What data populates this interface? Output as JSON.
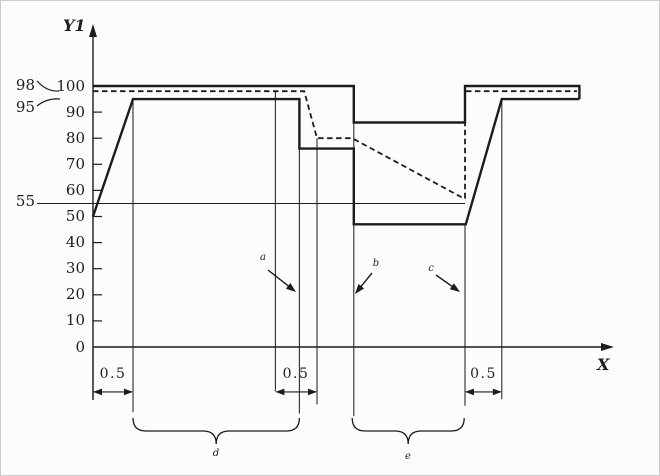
{
  "figure": {
    "background_color": "#fcfcfb",
    "line_color": "#1c1c1c",
    "description": "step-response diagram with solid and dashed curves, 0.5 dimension markers and brace annotations"
  },
  "chart_data": {
    "type": "line",
    "title": "",
    "xlabel": "X",
    "ylabel": "Y1",
    "ylim": [
      0,
      110
    ],
    "grid": false,
    "legend": "none",
    "y_ticks": [
      0,
      10,
      20,
      30,
      40,
      50,
      60,
      70,
      80,
      90,
      100
    ],
    "series": [
      {
        "name": "setpoint-step",
        "style": "solid",
        "width": 2.4,
        "points": [
          [
            0,
            100
          ],
          [
            3.26,
            100
          ],
          [
            3.26,
            86
          ],
          [
            4.65,
            86
          ],
          [
            4.65,
            100
          ],
          [
            6.08,
            100
          ],
          [
            6.08,
            95
          ]
        ]
      },
      {
        "name": "response-solid",
        "style": "solid",
        "width": 2.4,
        "points": [
          [
            0,
            50
          ],
          [
            0.5,
            95
          ],
          [
            2.58,
            95
          ],
          [
            2.58,
            76
          ],
          [
            3.26,
            76
          ],
          [
            3.26,
            47
          ],
          [
            4.66,
            47
          ],
          [
            5.11,
            95
          ],
          [
            6.08,
            95
          ]
        ]
      },
      {
        "name": "response-dashed",
        "style": "dashed",
        "width": 1.8,
        "points": [
          [
            0,
            98
          ],
          [
            2.64,
            98
          ],
          [
            2.8,
            80
          ],
          [
            3.24,
            80
          ],
          [
            4.63,
            57
          ],
          [
            4.65,
            57
          ],
          [
            4.65,
            98
          ],
          [
            6.05,
            98
          ]
        ]
      },
      {
        "name": "threshold-55-line",
        "style": "solid",
        "width": 1.1,
        "points": [
          [
            -0.7,
            55
          ],
          [
            4.65,
            55
          ]
        ]
      }
    ],
    "reference_labels": [
      {
        "text": "98",
        "value": 98
      },
      {
        "text": "95",
        "value": 95
      },
      {
        "text": "55",
        "value": 55
      }
    ],
    "guides": [
      {
        "u": 0,
        "v1": 0,
        "v2": -20
      },
      {
        "u": 0.5,
        "v1": 95,
        "v2": -25
      },
      {
        "u": 2.28,
        "v1": 98,
        "v2": -17
      },
      {
        "u": 2.58,
        "v1": 95,
        "v2": -25.5
      },
      {
        "u": 2.8,
        "v1": 80,
        "v2": -22
      },
      {
        "u": 3.26,
        "v1": 86,
        "v2": -26.5
      },
      {
        "u": 4.65,
        "v1": 47,
        "v2": -22.5
      },
      {
        "u": 5.11,
        "v1": 95,
        "v2": -20
      }
    ],
    "dimensions": [
      {
        "from_u": 0,
        "to_u": 0.5,
        "label": "0.5"
      },
      {
        "from_u": 2.28,
        "to_u": 2.8,
        "label": "0.5"
      },
      {
        "from_u": 4.65,
        "to_u": 5.11,
        "label": "0.5"
      }
    ],
    "braces": [
      {
        "from_u": 0.5,
        "to_u": 2.58,
        "label": "d"
      },
      {
        "from_u": 3.24,
        "to_u": 4.64,
        "label": "e"
      }
    ],
    "callouts": [
      {
        "label": "a",
        "arrow_from": [
          267,
          269
        ],
        "arrow_to": [
          295,
          291
        ]
      },
      {
        "label": "b",
        "arrow_from": [
          371,
          272
        ],
        "arrow_to": [
          354,
          293
        ]
      },
      {
        "label": "c",
        "arrow_from": [
          435,
          274
        ],
        "arrow_to": [
          459,
          291
        ]
      }
    ]
  }
}
